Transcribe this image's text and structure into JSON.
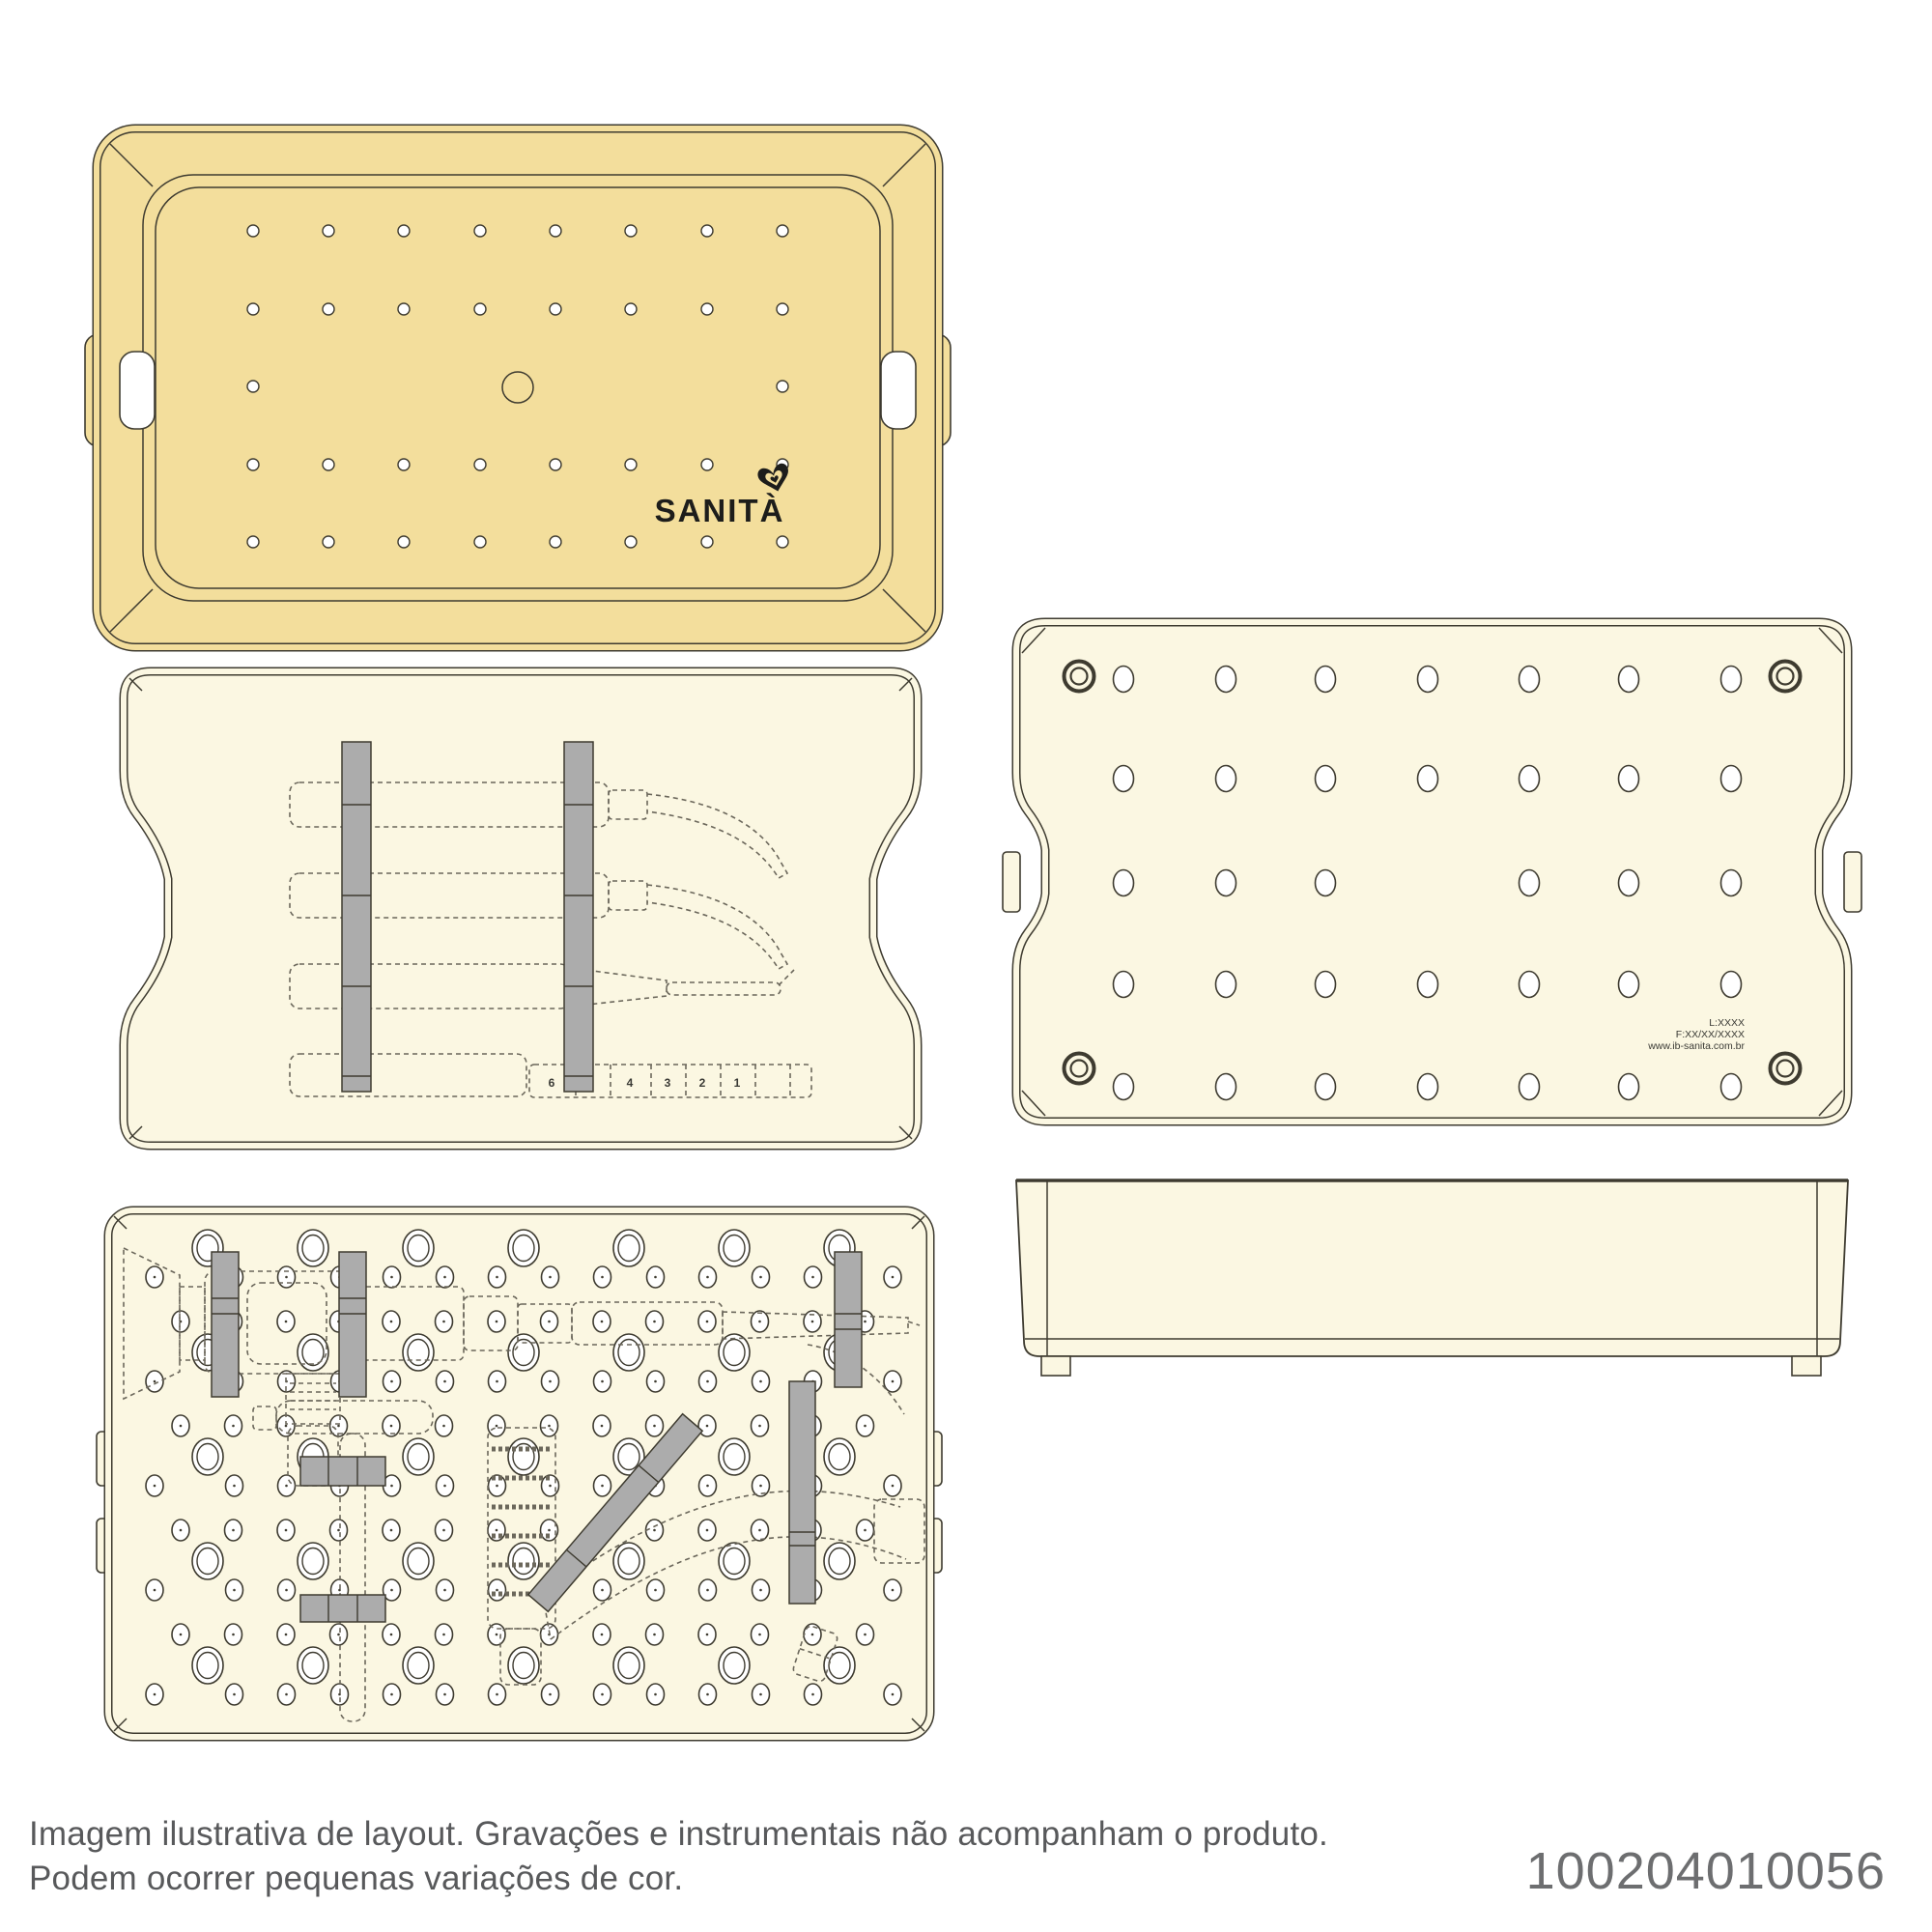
{
  "palette": {
    "page_bg": "#FFFFFF",
    "lid_fill": "#F3DE9C",
    "tray_fill": "#FBF7E2",
    "rail_fill": "#ACACAC",
    "line": "#3E3B30",
    "dash_line": "#6B675B",
    "hole_fill": "#FFFFFF",
    "logo_ink": "#1D1D1B",
    "engraving_ink": "#3A3A35",
    "disclaimer_ink": "#58595B",
    "code_ink": "#6D6E70"
  },
  "branding": {
    "logo_text": "SANITÀ",
    "logo_mark": "heart-icon"
  },
  "base_engraving": {
    "lot": "L:XXXX",
    "fabrication": "F:XX/XX/XXXX",
    "website": "www.ib-sanita.com.br"
  },
  "instrument_ruler": {
    "numbers": [
      "6",
      "4",
      "3",
      "2",
      "1"
    ]
  },
  "footer": {
    "disclaimer_line1": "Imagem ilustrativa de layout. Gravações e instrumentais não acompanham o produto.",
    "disclaimer_line2": "Podem ocorrer pequenas variações de cor.",
    "product_code": "100204010056"
  }
}
